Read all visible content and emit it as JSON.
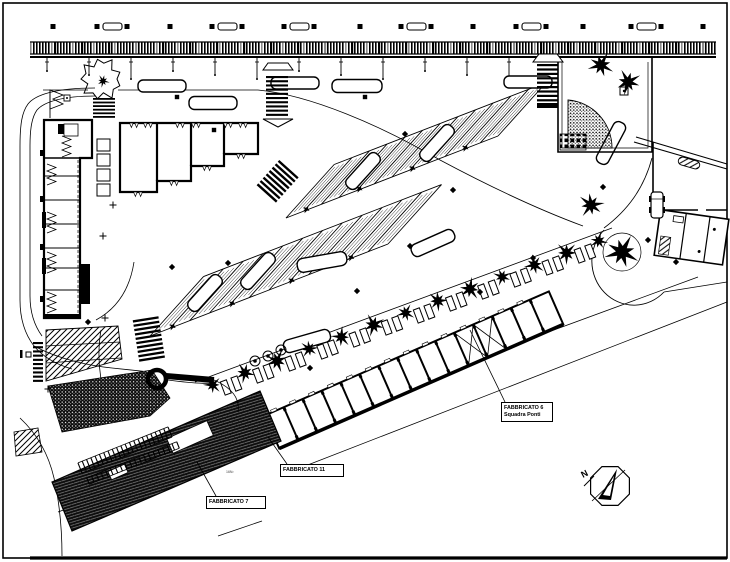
{
  "document": {
    "kind": "CAD site plan drawing"
  },
  "colors": {
    "ink": "#000000",
    "paper": "#ffffff",
    "gray": "#8a8a8a"
  },
  "labels": {
    "f7": {
      "text": "FABBRICATO 7",
      "x": 206,
      "y": 496,
      "w": 60,
      "leader": [
        216,
        496,
        197,
        462
      ]
    },
    "f11": {
      "text": "FABBRICATO 11",
      "x": 280,
      "y": 464,
      "w": 64,
      "leader": [
        287,
        464,
        268,
        437
      ]
    },
    "f6": {
      "text": "FABBRICATO 6",
      "text2": "Squadra Ponti",
      "x": 501,
      "y": 402,
      "w": 52,
      "leader": [
        505,
        402,
        470,
        330
      ]
    },
    "north": "N",
    "area_note": {
      "text": "16N²",
      "x": 226,
      "y": 470
    }
  },
  "drawing": {
    "frame": {
      "x": 3,
      "y": 3,
      "w": 724,
      "h": 555
    },
    "railway": {
      "x1": 30,
      "x2": 716,
      "y": 42,
      "h": 12,
      "heavy_y": 57
    },
    "platform": {
      "benches": [
        112,
        227,
        299,
        416,
        531,
        646
      ],
      "flank_dx": 15,
      "squares": [
        53,
        170,
        360,
        473,
        583,
        703
      ]
    },
    "posts": {
      "x0": 47,
      "step": 42,
      "count": 12,
      "y": 57
    },
    "roads": [
      "M43,90 L88,90",
      "M118,90 L258,90",
      "M258,90 C310,95 380,125 440,160 C500,192 545,212 583,226",
      "M95,88 C55,88 35,95 28,104 C22,112 20,124 20,146 L20,300 C20,318 24,333 34,346 C44,358 58,365 72,369",
      "M95,96 C62,96 44,102 37,110 C32,117 30,128 30,146 L30,296 C30,312 34,325 42,336",
      "M20,418 C35,432 48,452 54,478 C60,505 62,530 62,556",
      "M652,158 C644,188 628,210 604,228",
      "M58,512 L698,277",
      "M300,468 L727,302",
      "M218,536 L262,521",
      "M195,382 L612,228",
      "M168,380 C190,383 204,384 214,383",
      "M34,346 C60,360 92,366 112,368",
      "M112,368 L150,372",
      "M96,320 C118,308 130,288 134,262",
      "M101,330 C96,360 100,395 116,418",
      "M664,292 L727,282"
    ],
    "bands": [
      {
        "a": [
          286,
          218
        ],
        "b": [
          498,
          136
        ],
        "n": 13,
        "len": 72,
        "ang": -48
      },
      {
        "a": [
          150,
          336
        ],
        "b": [
          388,
          244
        ],
        "n": 13,
        "len": 80,
        "ang": -48
      }
    ],
    "buses": [
      [
        162,
        86,
        48,
        12,
        0
      ],
      [
        213,
        103,
        48,
        13,
        0
      ],
      [
        295,
        83,
        48,
        12,
        0
      ],
      [
        357,
        86,
        50,
        13,
        0
      ],
      [
        528,
        82,
        48,
        12,
        0
      ],
      [
        611,
        143,
        46,
        13,
        -62
      ],
      [
        363,
        171,
        44,
        13,
        -48
      ],
      [
        437,
        143,
        44,
        13,
        -48
      ],
      [
        205,
        293,
        44,
        13,
        -48
      ],
      [
        258,
        271,
        44,
        13,
        -48
      ],
      [
        322,
        262,
        50,
        14,
        -10
      ],
      [
        433,
        243,
        46,
        13,
        -24
      ],
      [
        307,
        341,
        48,
        13,
        -16
      ]
    ],
    "car": {
      "x": 651,
      "y": 192,
      "w": 12,
      "h": 26
    },
    "boulevard": {
      "a": [
        212,
        383
      ],
      "b": [
        598,
        239
      ],
      "trees": 13,
      "rings": [
        [
          255,
          361
        ],
        [
          268,
          356
        ],
        [
          281,
          350
        ]
      ]
    },
    "garage": {
      "x": 272,
      "y": 432,
      "ang": -23.6,
      "len": 310,
      "w": 36,
      "bays": 15,
      "xbays": [
        10,
        11
      ]
    },
    "f7_building": {
      "poly": [
        [
          52,
          482
        ],
        [
          260,
          391
        ],
        [
          281,
          441
        ],
        [
          72,
          531
        ]
      ],
      "ang": -24,
      "notches": [
        [
          190,
          437,
          44,
          16
        ],
        [
          118,
          472,
          18,
          9
        ]
      ]
    },
    "vegetation": [
      [
        48,
        386
      ],
      [
        152,
        370
      ],
      [
        170,
        398
      ],
      [
        150,
        416
      ],
      [
        62,
        432
      ]
    ],
    "hatch1": {
      "poly": [
        [
          46,
          330
        ],
        [
          118,
          326
        ],
        [
          122,
          359
        ],
        [
          46,
          381
        ]
      ],
      "inner": [
        [
          46,
          346,
          120,
          342
        ],
        [
          46,
          363,
          121,
          358
        ]
      ]
    },
    "hatch2": [
      [
        14,
        432
      ],
      [
        38,
        428
      ],
      [
        42,
        452
      ],
      [
        16,
        456
      ]
    ],
    "ladders": [
      {
        "a": [
          80,
          468
        ],
        "b": [
          170,
          432
        ],
        "n": 22,
        "half": 5.5
      },
      {
        "a": [
          88,
          481
        ],
        "b": [
          178,
          445
        ],
        "n": 20,
        "half": 3.5
      }
    ],
    "stars": [
      [
        601,
        65,
        12
      ],
      [
        628,
        82,
        12
      ],
      [
        622,
        252,
        16
      ],
      [
        591,
        205,
        12
      ]
    ],
    "diamonds": [
      [
        405,
        134
      ],
      [
        453,
        190
      ],
      [
        357,
        291
      ],
      [
        410,
        246
      ],
      [
        603,
        187
      ],
      [
        648,
        240
      ],
      [
        228,
        263
      ],
      [
        172,
        267
      ],
      [
        88,
        322
      ],
      [
        480,
        292
      ],
      [
        533,
        258
      ],
      [
        310,
        368
      ],
      [
        676,
        262
      ]
    ],
    "squares": [
      [
        177,
        97
      ],
      [
        365,
        97
      ],
      [
        214,
        130
      ]
    ],
    "plusmarks": [
      [
        113,
        205
      ],
      [
        103,
        236
      ],
      [
        105,
        318
      ],
      [
        48,
        389
      ]
    ],
    "roundabout": {
      "cx": 157,
      "cy": 379,
      "r": 9
    },
    "compass": {
      "x": 610,
      "y": 486,
      "r": 21
    }
  }
}
